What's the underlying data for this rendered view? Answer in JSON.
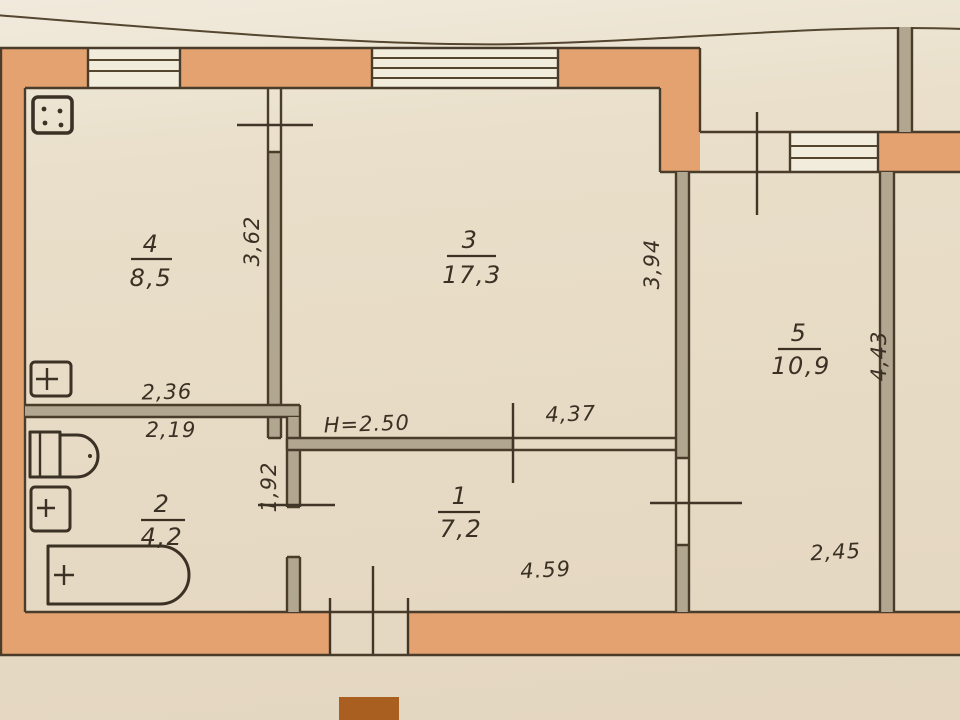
{
  "document": {
    "kind": "apartment-floor-plan-scan",
    "ceiling_height": "H=2.50",
    "rooms": [
      {
        "name": "kitchen",
        "number": "4",
        "area": "8,5"
      },
      {
        "name": "living-room",
        "number": "3",
        "area": "17,3"
      },
      {
        "name": "room-5",
        "number": "5",
        "area": "10,9"
      },
      {
        "name": "bathroom",
        "number": "2",
        "area": "4,2"
      },
      {
        "name": "hallway",
        "number": "1",
        "area": "7,2"
      }
    ],
    "dimensions": {
      "kitchen_width": "2,36",
      "kitchen_depth": "3,62",
      "bathroom_width": "2,19",
      "bathroom_depth": "1,92",
      "living_width": "4,37",
      "living_depth": "3,94",
      "hallway_width": "4.59",
      "room5_width": "2,45",
      "room5_depth": "4,43"
    },
    "icons": [
      "electric-stove-icon",
      "kitchen-sink-icon",
      "toilet-icon",
      "washbasin-icon",
      "bathtub-icon",
      "window-symbol"
    ],
    "colors": {
      "paper": "#e8dcc7",
      "wall_fill": "#e5a271",
      "interior_wall_fill": "#b1a68f",
      "window_fill": "#f2ecdd",
      "ink": "#493c2b",
      "stamp": "#a95f20"
    }
  }
}
